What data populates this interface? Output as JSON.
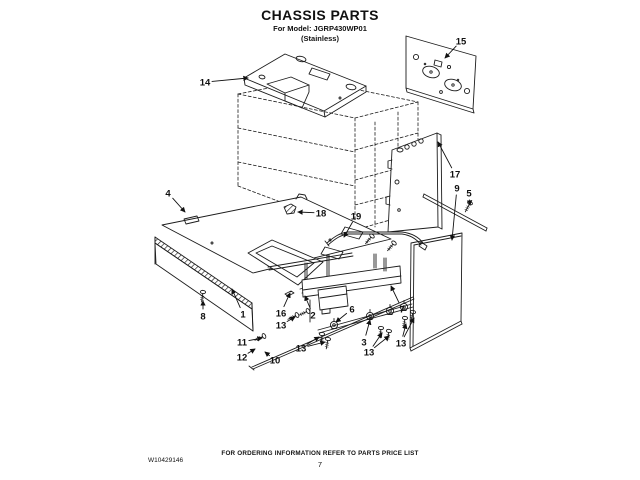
{
  "header": {
    "title": "CHASSIS PARTS",
    "model_line": "For Model: JGRP430WP01",
    "finish_line": "(Stainless)"
  },
  "footer": {
    "doc_number": "W10429146",
    "ordering_note": "FOR ORDERING INFORMATION REFER TO PARTS PRICE LIST",
    "page_number": "7"
  },
  "diagram": {
    "type": "exploded-parts-diagram",
    "callouts": [
      {
        "label": "14",
        "lx": 205,
        "ly": 82,
        "tx": 248,
        "ty": 78
      },
      {
        "label": "15",
        "lx": 461,
        "ly": 41,
        "tx": 445,
        "ty": 58
      },
      {
        "label": "17",
        "lx": 455,
        "ly": 174,
        "tx": 438,
        "ty": 142
      },
      {
        "label": "9",
        "lx": 457,
        "ly": 188,
        "tx": 452,
        "ty": 240
      },
      {
        "label": "5",
        "lx": 469,
        "ly": 193,
        "tx": 470,
        "ty": 205
      },
      {
        "label": "4",
        "lx": 168,
        "ly": 193,
        "tx": 185,
        "ty": 212
      },
      {
        "label": "18",
        "lx": 321,
        "ly": 213,
        "tx": 298,
        "ty": 212
      },
      {
        "label": "19",
        "lx": 356,
        "ly": 216,
        "tx": 344,
        "ty": 237
      },
      {
        "label": "8",
        "lx": 203,
        "ly": 316,
        "tx": 203,
        "ty": 301
      },
      {
        "label": "1",
        "lx": 243,
        "ly": 314,
        "tx": 232,
        "ty": 289
      },
      {
        "label": "16",
        "lx": 281,
        "ly": 313,
        "tx": 290,
        "ty": 293
      },
      {
        "label": "13",
        "lx": 281,
        "ly": 325,
        "tx": 295,
        "ty": 317
      },
      {
        "label": "2",
        "lx": 313,
        "ly": 315,
        "tx": 305,
        "ty": 296
      },
      {
        "label": "6",
        "lx": 352,
        "ly": 309,
        "tx": 336,
        "ty": 322
      },
      {
        "label": "7",
        "lx": 402,
        "ly": 309,
        "tx": 391,
        "ty": 286
      },
      {
        "label": "11",
        "lx": 242,
        "ly": 342,
        "tx": 262,
        "ty": 338
      },
      {
        "label": "12",
        "lx": 242,
        "ly": 357,
        "tx": 255,
        "ty": 349
      },
      {
        "label": "10",
        "lx": 275,
        "ly": 360,
        "tx": 265,
        "ty": 352
      },
      {
        "label": "13",
        "lx": 301,
        "ly": 348,
        "tx": 319,
        "ty": 337,
        "tx2": 325,
        "ty2": 342
      },
      {
        "label": "3",
        "lx": 364,
        "ly": 342,
        "tx": 370,
        "ty": 320
      },
      {
        "label": "13",
        "lx": 369,
        "ly": 352,
        "tx": 382,
        "ty": 333,
        "tx2": 389,
        "ty2": 336
      },
      {
        "label": "13",
        "lx": 401,
        "ly": 343,
        "tx": 406,
        "ty": 324,
        "tx2": 414,
        "ty2": 318
      }
    ]
  }
}
